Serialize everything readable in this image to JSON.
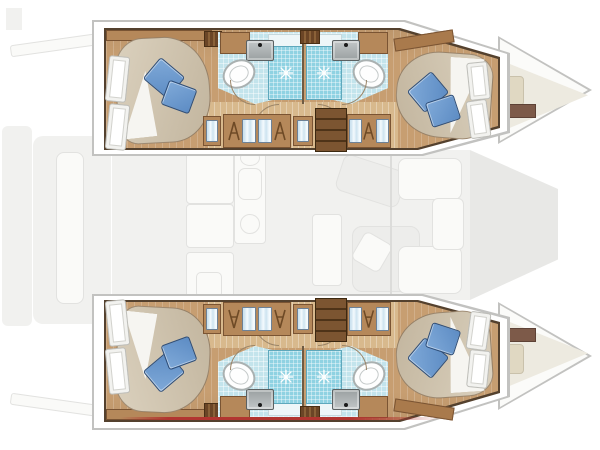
{
  "scene": {
    "type": "yacht-floor-plan",
    "vessel": "catamaran",
    "view": "top-down interior layout, bow to the right",
    "hulls": [
      {
        "id": "port",
        "rooms": [
          "aft-cabin",
          "aft-bathroom-with-shower",
          "corridor-with-wardrobes",
          "forward-bathroom-with-shower",
          "forward-cabin"
        ]
      },
      {
        "id": "starboard",
        "rooms": [
          "aft-cabin",
          "aft-bathroom-with-shower",
          "corridor-with-wardrobes",
          "forward-bathroom-with-shower",
          "forward-cabin"
        ]
      }
    ],
    "deck_ghost_elements": [
      "aft-platform",
      "davits",
      "cockpit-bench",
      "galley",
      "dinette-table",
      "sofa",
      "forward-cockpit",
      "trampoline",
      "bow-seats"
    ],
    "fixtures_per_hull": [
      "double-bed",
      "two-blue-pillows",
      "headboard-slats",
      "wardrobe-hangers",
      "companionway-stairs",
      "shower-with-drain",
      "toilet",
      "sink",
      "door-swing-arcs"
    ]
  },
  "colors": {
    "wood": "#c79e71",
    "woodF": "#b5885a",
    "woodDk": "#7a5433",
    "corr": "#d8b98d",
    "duvetL": "#dbd1be",
    "duvetD": "#c2b59e",
    "pilL": "#7fa9d8",
    "pilD": "#5d8cc4",
    "pilE": "#2e4d77",
    "bath": "#c3e4ec",
    "shower": "#8fd2e2",
    "tray": "#eef6f8",
    "outline": "#54412e",
    "shellLine": "#c2c2c0",
    "ghostFill": "#f1f1ef",
    "ghostLine": "#e2e2e0",
    "ghostItem": "#fafaf8",
    "tramp": "#e8e8e6",
    "cream": "#edeae0",
    "bowBar": "#7d5a49",
    "bowCush": "#e0d8c2",
    "red": "#b23530",
    "arcC": "#9b8568"
  }
}
